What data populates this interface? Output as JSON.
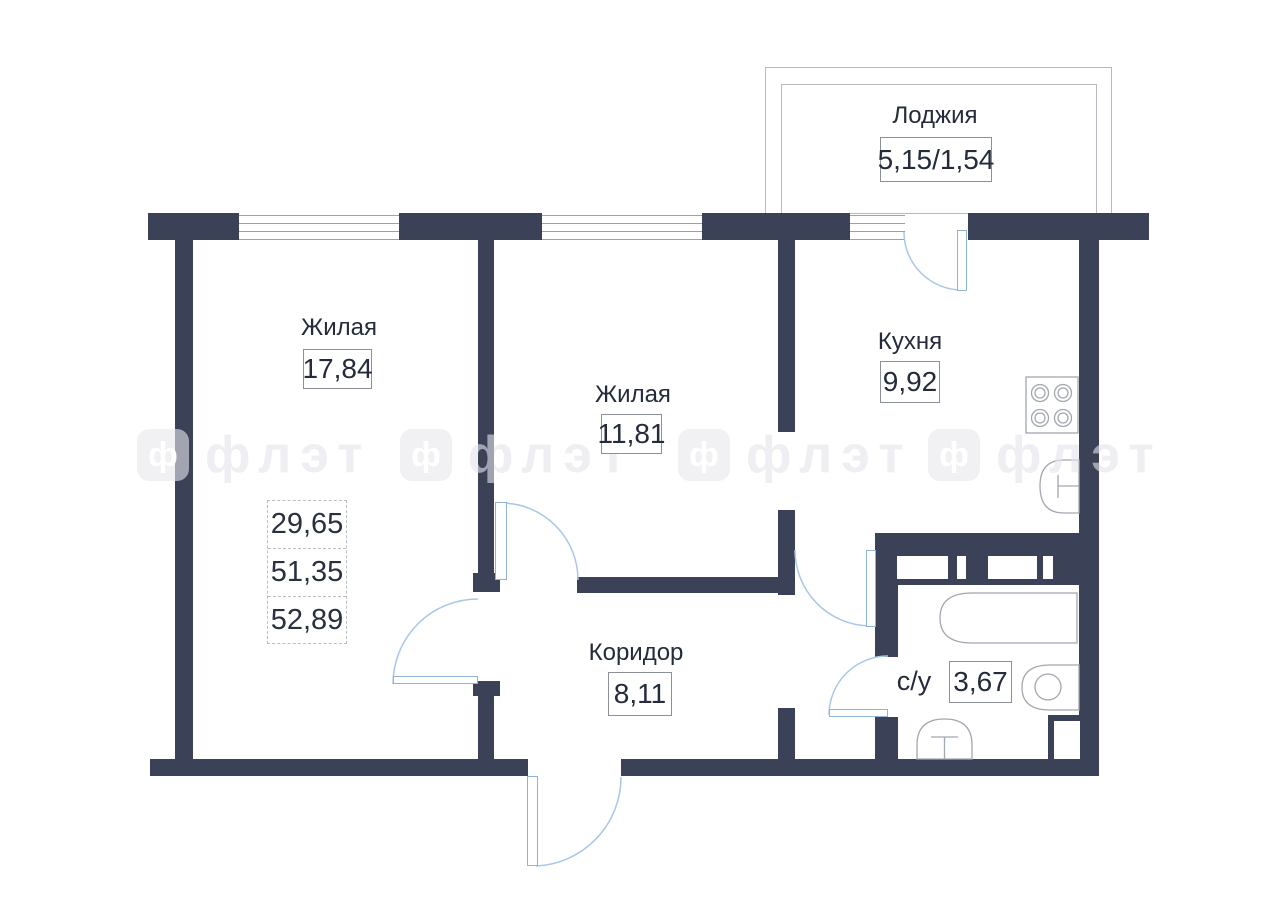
{
  "plan": {
    "loggia": {
      "label": "Лоджия",
      "area": "5,15/1,54"
    },
    "living1": {
      "label": "Жилая",
      "area": "17,84"
    },
    "living2": {
      "label": "Жилая",
      "area": "11,81"
    },
    "kitchen": {
      "label": "Кухня",
      "area": "9,92"
    },
    "corridor": {
      "label": "Коридор",
      "area": "8,11"
    },
    "bathroom": {
      "label": "с/у",
      "area": "3,67"
    },
    "summary": {
      "living_area": "29,65",
      "area_without_loggia": "51,35",
      "total_area": "52,89"
    },
    "watermark": {
      "letter": "ф",
      "text": "флэт"
    },
    "colors": {
      "wall": "#3b4257",
      "door_arc": "#a9c8e6",
      "fixture_outline": "#a2a7b0",
      "text": "#252b3b"
    }
  }
}
